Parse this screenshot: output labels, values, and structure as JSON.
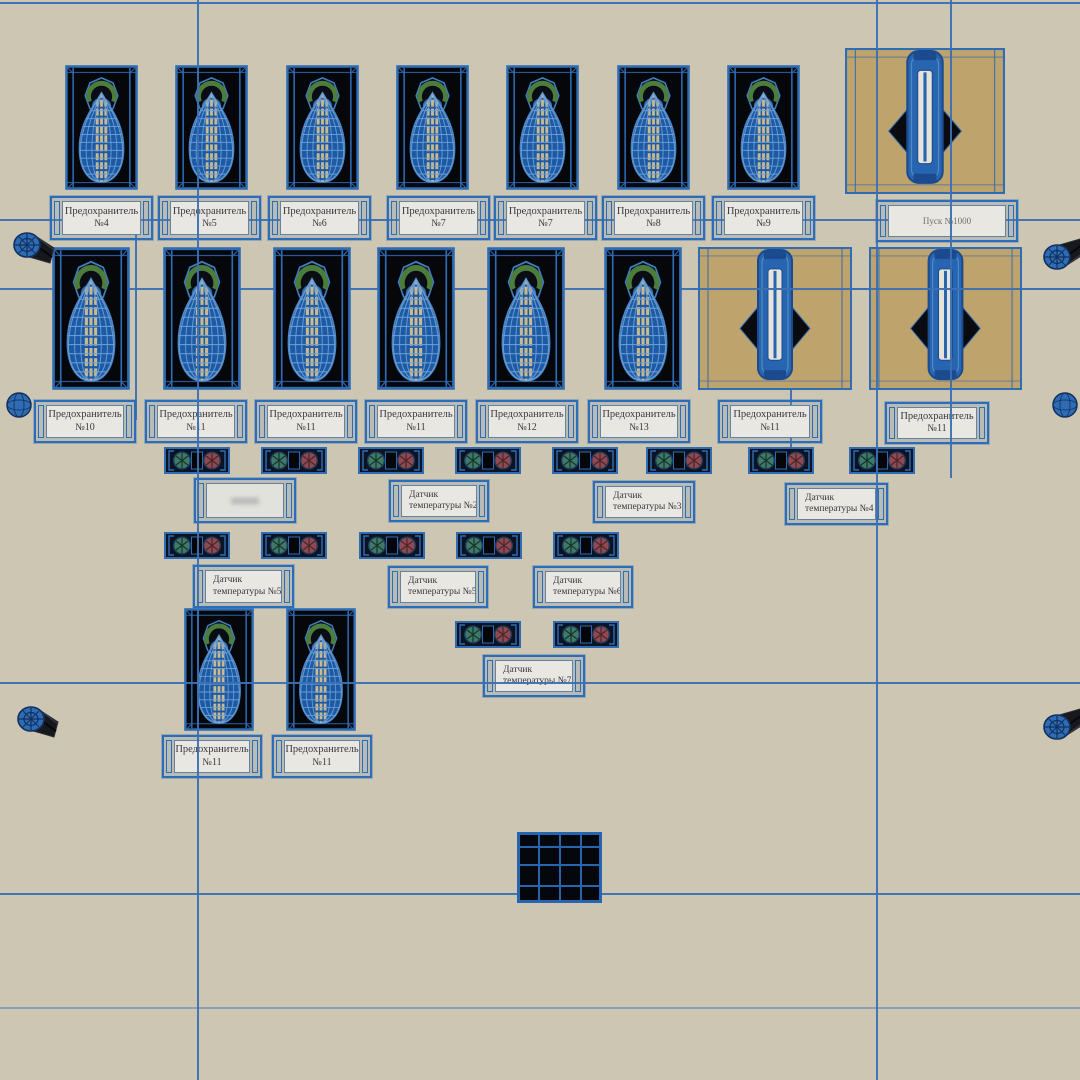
{
  "scene": {
    "fuse_plate_word": "Предохранитель",
    "top_fuse_plates": [
      "№4",
      "№5",
      "№6",
      "№7",
      "№7",
      "№8",
      "№9"
    ],
    "starter_plate": "Пуск №1000",
    "mid_fuse_plates": [
      "№10",
      "№11",
      "№11",
      "№11",
      "№12",
      "№13"
    ],
    "mid_switch_plates": [
      "№11",
      "№11"
    ],
    "bottom_fuse_plates": [
      "№11",
      "№11"
    ],
    "sensor_plates_row1": [
      {
        "line1": "",
        "line2": ""
      },
      {
        "line1": "Датчик",
        "line2": "температуры №2"
      },
      {
        "line1": "Датчик",
        "line2": "температуры №3"
      },
      {
        "line1": "Датчик",
        "line2": "температуры №4"
      }
    ],
    "sensor_plates_row2": [
      {
        "line1": "Датчик",
        "line2": "температуры №5"
      },
      {
        "line1": "Датчик",
        "line2": "температуры №5"
      },
      {
        "line1": "Датчик",
        "line2": "температуры №6"
      }
    ],
    "sensor_plates_row3": [
      {
        "line1": "Датчик",
        "line2": "температуры №7"
      }
    ],
    "colors": {
      "background": "#ccc6b3",
      "wire_blue": "#3c70b2",
      "object_blue": "#2e6cb4",
      "panel_black": "#06070b",
      "switch_tan": "#bfa36c",
      "plate_fill": "#e9e7e1",
      "plate_text": "#383840",
      "terminal_green": "#3f7a68",
      "terminal_red": "#8e4a50",
      "fuse_arc_green": "#4c7d3c",
      "fuse_stripe_tan": "#c9b98f"
    }
  }
}
